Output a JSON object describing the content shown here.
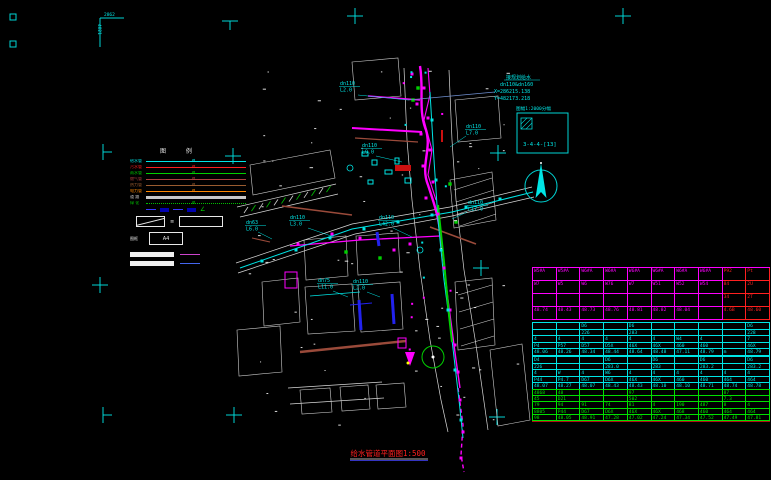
{
  "drawing": {
    "title": "给水管道平面图1:500",
    "corner_top": "2862",
    "corner_left": "4821"
  },
  "annotation": {
    "line1": "接规划给水",
    "line2": "dn110&dn160",
    "line3": "X=286215.138",
    "line4": "Y=482173.218"
  },
  "sheet_index": {
    "label": "图幅1:2000分幅",
    "cell": "3-4-4-[13]"
  },
  "north": {
    "label": ""
  },
  "legend": {
    "title": "图 例",
    "items": [
      {
        "label": "给水管",
        "color": "#00e5e5",
        "style": "solid",
        "weight": 1
      },
      {
        "label": "污水管",
        "color": "#ff2020",
        "style": "solid",
        "weight": 1
      },
      {
        "label": "雨水管",
        "color": "#00d000",
        "style": "solid",
        "weight": 1
      },
      {
        "label": "燃气管",
        "color": "#b04040",
        "style": "solid",
        "weight": 1
      },
      {
        "label": "热力管",
        "color": "#9a5c30",
        "style": "solid",
        "weight": 1
      },
      {
        "label": "电力管",
        "color": "#ff8800",
        "style": "solid",
        "weight": 1
      },
      {
        "label": "道 路",
        "color": "#c8c8c8",
        "style": "solid",
        "weight": 3
      },
      {
        "label": "绿 化",
        "color": "#00c000",
        "style": "dotted",
        "weight": 1
      }
    ],
    "angle_glyph": "∠",
    "small_mark": "≡",
    "frame_label": "图框",
    "a4_label": "A4"
  },
  "pipe_labels": [
    {
      "dn": "dn110",
      "len": "L2.0"
    },
    {
      "dn": "dn110",
      "len": "L9.0"
    },
    {
      "dn": "dn110",
      "len": "L7.0"
    },
    {
      "dn": "dn110",
      "len": "L17.0"
    },
    {
      "dn": "dn110",
      "len": "L3.0"
    },
    {
      "dn": "dn110",
      "len": "L42.0"
    },
    {
      "dn": "dn63",
      "len": "L6.0"
    },
    {
      "dn": "dn75",
      "len": "L11.0"
    },
    {
      "dn": "dn110",
      "len": "L2.0"
    }
  ],
  "table": {
    "blocks": [
      {
        "color": "#ff00ff",
        "red_cols": [
          8,
          9
        ],
        "red_color": "#ff2020",
        "rows": [
          [
            "W5#A",
            "W5#A",
            "W6#A",
            "W6#A",
            "W6#A",
            "W6#A",
            "W6#A",
            "W6#A",
            "P92",
            "Pt"
          ],
          [
            "W7",
            "W5",
            "W6",
            "W76",
            "W7",
            "W51",
            "W52",
            "W54",
            "84",
            "2U"
          ],
          [
            "",
            "",
            "",
            "",
            "",
            "",
            "",
            "",
            "34",
            "2T"
          ],
          [
            "48.74",
            "48.43",
            "48.73",
            "48.76",
            "48.81",
            "48.82",
            "48.04",
            "",
            "4.6B",
            "48.60"
          ]
        ]
      },
      {
        "color": "#00e5e5",
        "rows": [
          [
            "",
            "",
            "D6",
            "",
            "D6",
            "",
            "",
            "",
            "",
            "D6"
          ],
          [
            "",
            "",
            "226",
            "",
            "283",
            "",
            "",
            "",
            "",
            "228"
          ],
          [
            "4",
            "4",
            "4",
            "4",
            "4",
            "4",
            "W4",
            "4",
            "",
            "7"
          ],
          [
            "P4",
            "P57",
            "D57",
            "D5X",
            "46X",
            "46X",
            "460",
            "460",
            "",
            "46X"
          ],
          [
            "48.06",
            "48.26",
            "48.34",
            "48.44",
            "48.64",
            "48.48",
            "47.11",
            "48.79",
            "m",
            "48.79"
          ]
        ]
      },
      {
        "color": "#00e5e5",
        "rows": [
          [
            "D4",
            "",
            "",
            "D6",
            "",
            "D6",
            "",
            "D6",
            "",
            "D6"
          ],
          [
            "226",
            "",
            "",
            "283.0",
            "",
            "283",
            "",
            "283.2",
            "",
            "283.2"
          ],
          [
            "4",
            "W",
            "4",
            "W6",
            "4",
            "4",
            "4",
            "4",
            "4",
            "4"
          ],
          [
            "P44",
            "P4.7",
            "D67",
            "D6X",
            "46X",
            "46X",
            "460",
            "460",
            "464",
            "464"
          ],
          [
            "48.07",
            "48.27",
            "48.07",
            "48.43",
            "48.43",
            "48.10",
            "48.10",
            "48.71",
            "48.74",
            "48.78"
          ]
        ]
      },
      {
        "color": "#00e000",
        "rows": [
          [
            "4868",
            "48",
            "",
            "",
            "97",
            "",
            "",
            "",
            "87",
            ""
          ],
          [
            "45",
            "D21",
            "",
            "",
            "502",
            "",
            "",
            "",
            "7.3",
            ""
          ],
          [
            "79",
            "94",
            "91",
            "74",
            "81",
            "4",
            "190",
            "487",
            "8",
            "4"
          ],
          [
            "8805",
            "P44",
            "D67",
            "D6X",
            "46X",
            "46X",
            "468",
            "460",
            "464",
            "464"
          ],
          [
            "98",
            "48.05",
            "48.91",
            "47.28",
            "47.02",
            "47.24",
            "47.34",
            "47.52",
            "47.49",
            "47.81"
          ]
        ]
      }
    ]
  }
}
